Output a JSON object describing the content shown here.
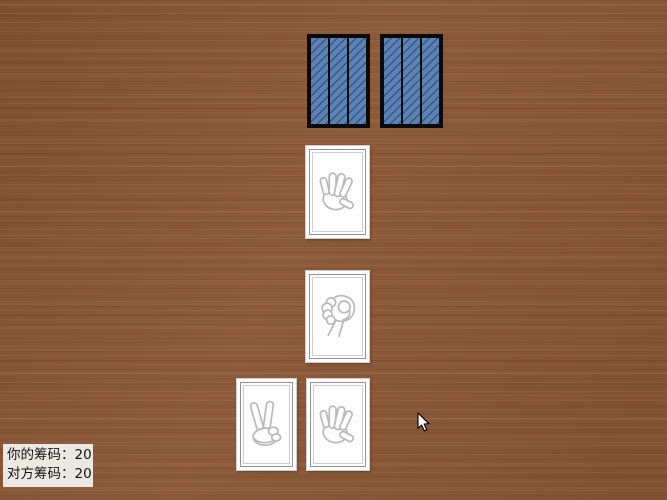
{
  "colors": {
    "table_wood": "#8a5634",
    "card_back_blue": "#5d83b6",
    "card_back_frame": "#0b0b0b",
    "card_front": "#fdfdfd",
    "icon_stroke": "#b9b9b9",
    "hud_background": "#ebe8e4",
    "hud_text": "#111111"
  },
  "opponent_hand": {
    "cards": [
      {
        "face": "down",
        "icon": "card-back-pattern"
      },
      {
        "face": "down",
        "icon": "card-back-pattern"
      }
    ]
  },
  "center_column": {
    "top_card": {
      "face": "up",
      "icon": "paper-hand-icon"
    },
    "bottom_card": {
      "face": "up",
      "icon": "rock-fist-icon"
    }
  },
  "player_hand": {
    "cards": [
      {
        "face": "up",
        "icon": "scissors-hand-icon"
      },
      {
        "face": "up",
        "icon": "paper-hand-icon"
      }
    ]
  },
  "hud": {
    "rows": [
      {
        "label": "你的筹码：",
        "value": "20"
      },
      {
        "label": "对方筹码：",
        "value": "20"
      }
    ]
  },
  "cursor": {
    "icon": "arrow-cursor"
  }
}
